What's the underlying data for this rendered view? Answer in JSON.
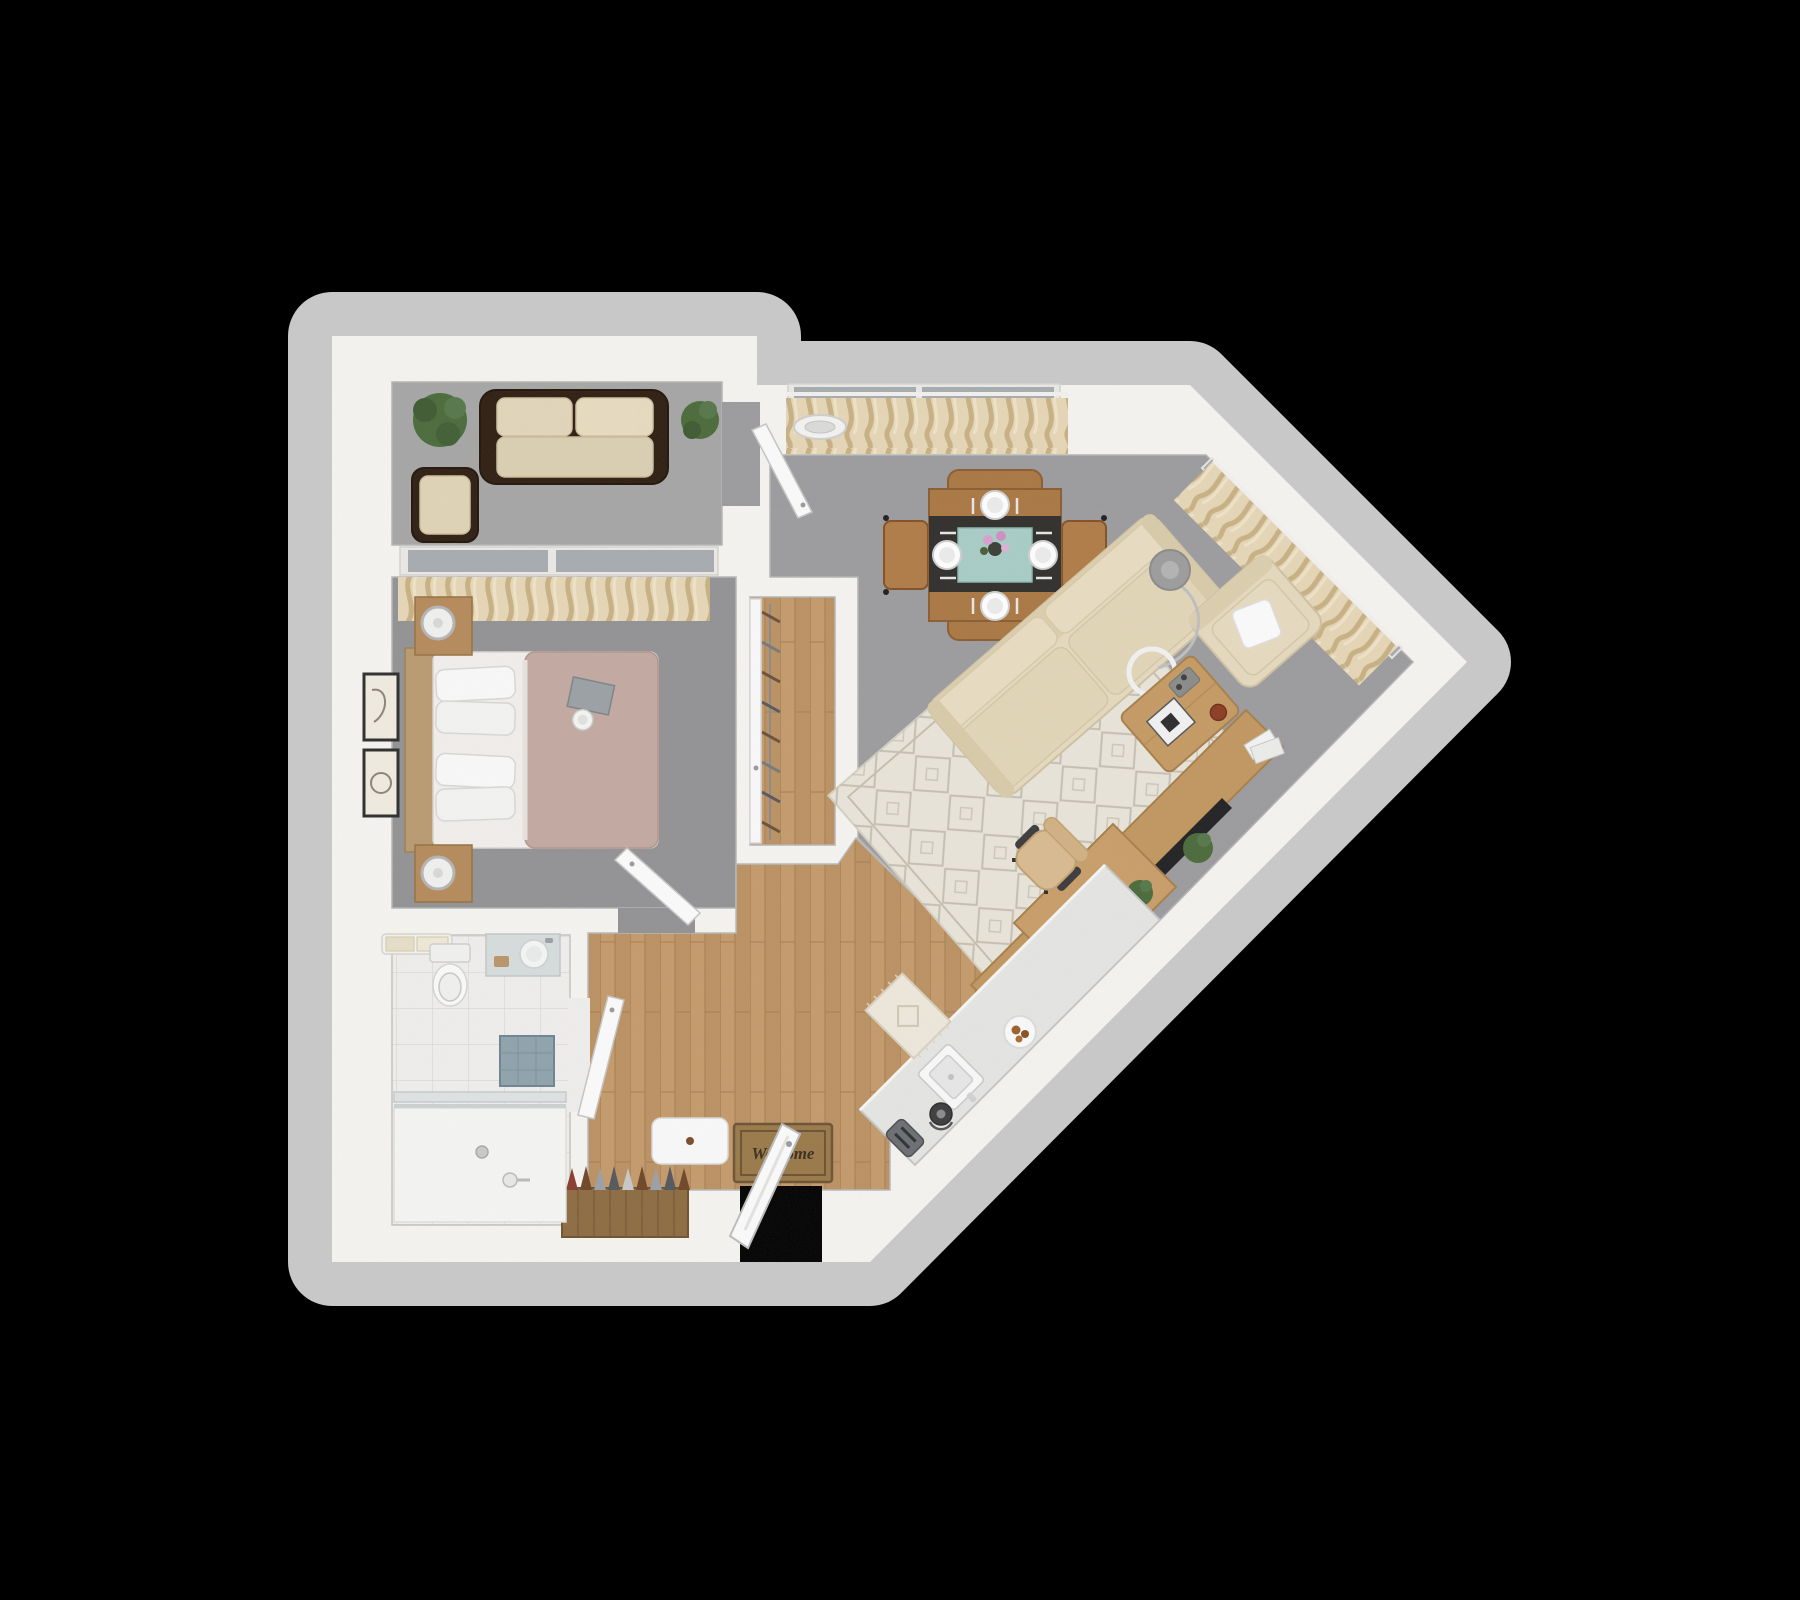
{
  "scene": {
    "type": "3d-floorplan-top-down-render",
    "description": "One-bedroom apartment 3D floor plan on black background"
  },
  "entry": {
    "welcome_mat_text": "Welcome"
  },
  "colors": {
    "background": "#000000",
    "wall": "#f7f5f1",
    "wall_shadow": "#c8c8c8",
    "carpet_living": "#9c9c9f",
    "carpet_bedroom": "#929295",
    "carpet_balcony": "#a6a6a6",
    "wood_floor": "#c49a6a",
    "wood_dark": "#a57e4f",
    "tile": "#f0efed",
    "counter": "#e6e6e4",
    "curtain": "#e6d7b6",
    "sofa": "#e6dabe",
    "rug": "#e9e5da",
    "dining_wood": "#aa7742",
    "runner": "#2f2d2a",
    "placemat_teal": "#a8cdc6",
    "outdoor_frame": "#2e1d10",
    "duvet": "#c3a9a1",
    "door": "#fcfcfc",
    "tv": "#202022",
    "plant": "#4a6a39",
    "mat_brown": "#9a7948",
    "mat_text_color": "#3a2d1b",
    "glass": "#a7acb0"
  },
  "rooms": [
    {
      "name": "balcony",
      "floor": "carpet",
      "furniture": [
        "outdoor-sofa",
        "outdoor-armchair",
        "potted-plant-left",
        "potted-plant-right"
      ]
    },
    {
      "name": "bedroom",
      "floor": "carpet",
      "furniture": [
        "queen-bed",
        "headboard",
        "nightstand-top",
        "nightstand-bottom",
        "table-lamp-top",
        "table-lamp-bottom",
        "wall-art-upper",
        "wall-art-lower",
        "window-curtain",
        "book-and-coffee-tray",
        "bedroom-door"
      ]
    },
    {
      "name": "closet",
      "floor": "hardwood",
      "furniture": [
        "hanging-rod",
        "clothes-hangers",
        "closet-door"
      ]
    },
    {
      "name": "living-dining-room",
      "floor": "carpet",
      "furniture": [
        "dining-table",
        "dining-chair-left",
        "dining-chair-right",
        "dining-bench-top",
        "dining-bench-bottom",
        "place-settings",
        "flower-vase",
        "sectional-sofa",
        "accent-armchair",
        "throw-pillow",
        "arc-floor-lamp",
        "area-rug",
        "coffee-table",
        "board-game",
        "media-console",
        "television",
        "soundbar",
        "console-plant",
        "magazines",
        "desk",
        "office-chair",
        "laptop",
        "desk-plant",
        "ceiling-light",
        "balcony-door",
        "window-curtains"
      ]
    },
    {
      "name": "kitchen-entry",
      "floor": "hardwood",
      "furniture": [
        "kitchen-counter",
        "sink",
        "kettle",
        "toaster",
        "breakfast-plate",
        "kitchen-rug",
        "welcome-mat",
        "entry-bench",
        "shoe-rack",
        "front-door"
      ]
    },
    {
      "name": "bathroom",
      "floor": "tile",
      "furniture": [
        "toilet",
        "vanity-sink",
        "towel-bar",
        "walk-in-shower",
        "shower-glass-door",
        "accent-tile",
        "bathroom-door"
      ]
    }
  ]
}
